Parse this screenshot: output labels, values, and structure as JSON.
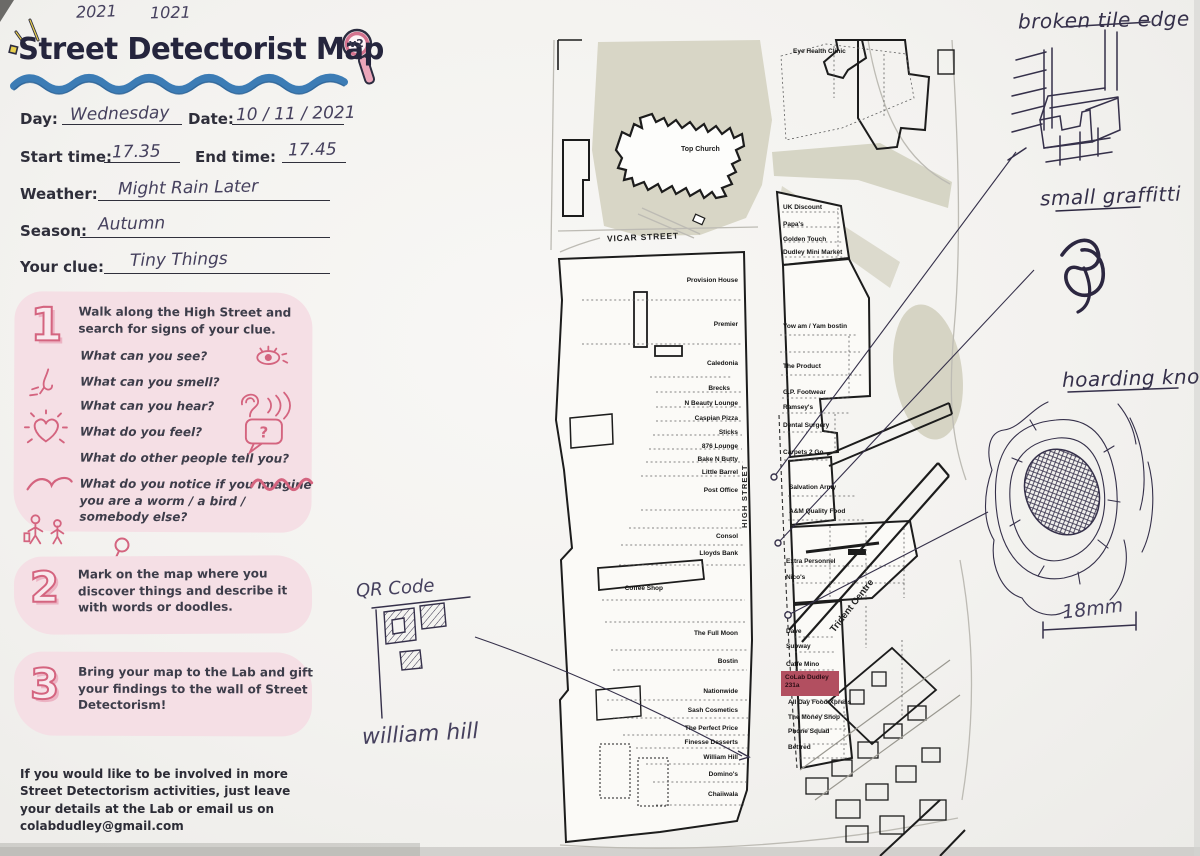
{
  "photo": {
    "scribble_left": "2021",
    "scribble_right": "1021"
  },
  "header": {
    "title": "Street Detectorist Map",
    "badge": "v2"
  },
  "form": {
    "day_label": "Day:",
    "day_value": "Wednesday",
    "date_label": "Date:",
    "date_value": "10 / 11 / 2021",
    "start_label": "Start time:",
    "start_value": "17.35",
    "end_label": "End time:",
    "end_value": "17.45",
    "weather_label": "Weather:",
    "weather_value": "Might Rain Later",
    "season_label": "Season:",
    "season_value": "Autumn",
    "clue_label": "Your clue:",
    "clue_value": "Tiny Things"
  },
  "steps": [
    {
      "number": "1",
      "intro": "Walk along the High Street and search for signs of your clue.",
      "bubble": "?",
      "questions": [
        "What can you see?",
        "What can you smell?",
        "What can you hear?",
        "What do you feel?",
        "What do other people tell you?",
        "What do you notice if you imagine you are a worm / a bird / somebody else?"
      ]
    },
    {
      "number": "2",
      "text": "Mark on the map where you discover things and describe it with words or doodles."
    },
    {
      "number": "3",
      "text": "Bring your map to the Lab and gift your findings to the wall of Street Detectorism!"
    }
  ],
  "footer": {
    "text": "If you would like to be involved in more Street Detectorism activities, just leave your details at the Lab or email us on colabdudley@gmail.com"
  },
  "map": {
    "labels": {
      "church": "Top Church",
      "vicar_street": "VICAR STREET",
      "high_street": "HIGH STREET",
      "trident_centre": "Trident Centre"
    },
    "west_shops": [
      "Provision House",
      "Premier",
      "Caledonia",
      "Brecks",
      "N Beauty Lounge",
      "Caspian Pizza",
      "Sticks",
      "876 Lounge",
      "Bake N Butty",
      "Little Barrel",
      "Post Office",
      "Consol",
      "Lloyds Bank",
      "Coffee Shop",
      "The Full Moon",
      "Bostin",
      "Nationwide",
      "Sash Cosmetics",
      "The Perfect Price",
      "Finesse Desserts",
      "William Hill",
      "Domino's",
      "Chaiiwala"
    ],
    "east_shops": [
      "Eye Health Clinic",
      "UK Discount",
      "Papa's",
      "Golden Touch",
      "Dudley Mini Market",
      "Yow am / Yam bostin",
      "The Product",
      "G.P. Footwear",
      "Ramsey's",
      "Dental Surgery",
      "Carpets 2 Go",
      "Salvation Army",
      "A&M Quality Food",
      "Extra Personnel",
      "Nico's",
      "Dave",
      "Subway",
      "Caffe Mino",
      "All Day Food Xpress",
      "The Money Shop",
      "Phone Squad",
      "Betfred"
    ],
    "highlight": {
      "line1": "CoLab Dudley",
      "line2": "231a"
    }
  },
  "annotations": {
    "broken_tile": "broken tile edge",
    "graffiti": "small graffitti",
    "knot": "hoarding knot",
    "scale": "18mm",
    "qr": "QR Code",
    "william_hill": "william hill"
  },
  "colors": {
    "accent_pink": "#d4647f",
    "panel_pink": "#f5dfe5",
    "wave_blue": "#3c7cb5",
    "highlight_red": "#b24f60",
    "ink": "#35304a",
    "map_beige": "#d8d6c6"
  }
}
